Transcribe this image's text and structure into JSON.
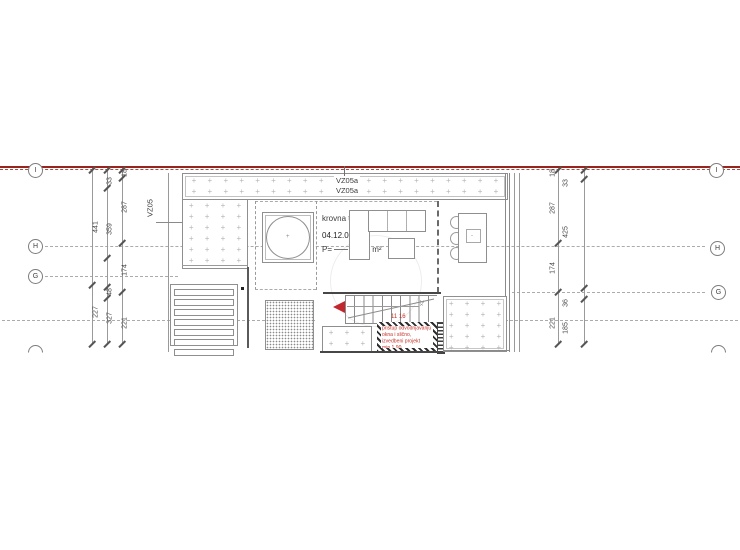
{
  "plan": {
    "terrace_label": {
      "name": "krovna terasa",
      "code": "04.12.01",
      "area_prefix": "P=",
      "area_value": "56,14 m²"
    },
    "vz_labels": {
      "vz05": "VZ05",
      "vz05a_top": "VZ05a",
      "vz05a_bottom": "VZ05a"
    },
    "red_note": {
      "lines": [
        "pristup odvodnjavanju",
        "okna i slično,",
        "izvedbeni projekt",
        "min 1 90"
      ],
      "stair_dim": "11 16",
      "stair_mark": "2x"
    }
  },
  "grid_markers": [
    {
      "letter": "I",
      "cx": 35,
      "cy": 170,
      "partial": false
    },
    {
      "letter": "H",
      "cx": 35,
      "cy": 246,
      "partial": false
    },
    {
      "letter": "G",
      "cx": 35,
      "cy": 276,
      "partial": false
    },
    {
      "letter": "",
      "cx": 35,
      "cy": 352,
      "partial": true
    },
    {
      "letter": "I",
      "cx": 716,
      "cy": 170,
      "partial": false
    },
    {
      "letter": "H",
      "cx": 717,
      "cy": 248,
      "partial": false
    },
    {
      "letter": "G",
      "cx": 718,
      "cy": 292,
      "partial": false
    },
    {
      "letter": "",
      "cx": 718,
      "cy": 352,
      "partial": true
    }
  ],
  "dimensions": [
    {
      "x": 96,
      "y": 227,
      "t": "441"
    },
    {
      "x": 96,
      "y": 312,
      "t": "227"
    },
    {
      "x": 110,
      "y": 181,
      "t": "33"
    },
    {
      "x": 110,
      "y": 229,
      "t": "359"
    },
    {
      "x": 110,
      "y": 292,
      "t": "48"
    },
    {
      "x": 110,
      "y": 318,
      "t": "327"
    },
    {
      "x": 125,
      "y": 173,
      "t": "18"
    },
    {
      "x": 125,
      "y": 207,
      "t": "287"
    },
    {
      "x": 125,
      "y": 270,
      "t": "174"
    },
    {
      "x": 125,
      "y": 323,
      "t": "221"
    },
    {
      "x": 553,
      "y": 173,
      "t": "18"
    },
    {
      "x": 553,
      "y": 208,
      "t": "287"
    },
    {
      "x": 553,
      "y": 268,
      "t": "174"
    },
    {
      "x": 553,
      "y": 323,
      "t": "221"
    },
    {
      "x": 566,
      "y": 183,
      "t": "33"
    },
    {
      "x": 566,
      "y": 232,
      "t": "425"
    },
    {
      "x": 566,
      "y": 303,
      "t": "36"
    },
    {
      "x": 566,
      "y": 328,
      "t": "185"
    }
  ],
  "dim_lines": [
    {
      "x": 92
    },
    {
      "x": 107
    },
    {
      "x": 122
    },
    {
      "x": 558
    },
    {
      "x": 584
    }
  ],
  "gridlines": [
    {
      "x": 45,
      "y": 246,
      "w": 660
    },
    {
      "x": 45,
      "y": 276,
      "w": 133
    },
    {
      "x": 512,
      "y": 292,
      "w": 193
    },
    {
      "x": 2,
      "y": 320,
      "w": 313
    },
    {
      "x": 505,
      "y": 320,
      "w": 233
    }
  ],
  "ticks": [
    {
      "x": 92,
      "y": 170
    },
    {
      "x": 92,
      "y": 285
    },
    {
      "x": 92,
      "y": 344
    },
    {
      "x": 107,
      "y": 170
    },
    {
      "x": 107,
      "y": 188
    },
    {
      "x": 107,
      "y": 258
    },
    {
      "x": 107,
      "y": 287
    },
    {
      "x": 107,
      "y": 298
    },
    {
      "x": 107,
      "y": 344
    },
    {
      "x": 122,
      "y": 170
    },
    {
      "x": 122,
      "y": 178
    },
    {
      "x": 122,
      "y": 243
    },
    {
      "x": 122,
      "y": 292
    },
    {
      "x": 122,
      "y": 344
    },
    {
      "x": 558,
      "y": 170
    },
    {
      "x": 558,
      "y": 243
    },
    {
      "x": 558,
      "y": 292
    },
    {
      "x": 558,
      "y": 344
    },
    {
      "x": 584,
      "y": 170
    },
    {
      "x": 584,
      "y": 179
    },
    {
      "x": 584,
      "y": 288
    },
    {
      "x": 584,
      "y": 299
    },
    {
      "x": 584,
      "y": 344
    }
  ],
  "colors": {
    "cut_line": "#97251f",
    "red_accent": "#c1272d",
    "note_red": "#c63127",
    "cad_line": "#9a9a9a",
    "dark_line": "#555555"
  }
}
